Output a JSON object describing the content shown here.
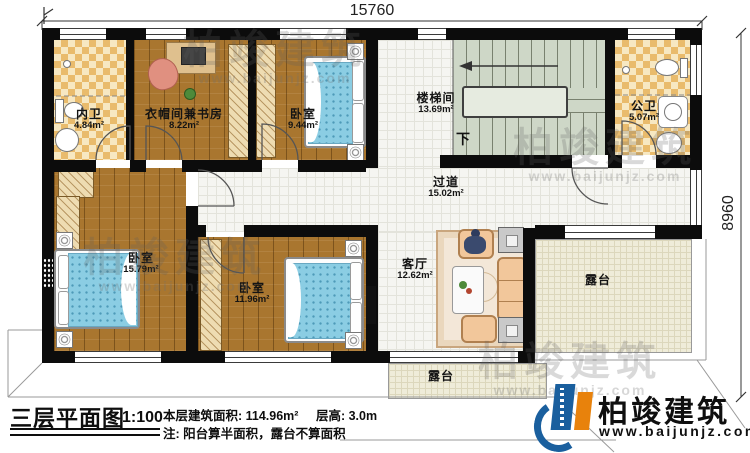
{
  "dimensions": {
    "width_top": "15760",
    "height_right": "8960"
  },
  "rooms": {
    "neiwei": {
      "name": "内卫",
      "area": "4.84m²"
    },
    "cloak_study": {
      "name": "衣帽间兼书房",
      "area": "8.22m²"
    },
    "bedroom_top": {
      "name": "卧室",
      "area": "9.44m²"
    },
    "stairwell": {
      "name": "楼梯间",
      "area": "13.69m²"
    },
    "public_bath": {
      "name": "公卫",
      "area": "5.07m²"
    },
    "corridor": {
      "name": "过道",
      "area": "15.02m²"
    },
    "bedroom_left": {
      "name": "卧室",
      "area": "15.79m²"
    },
    "bedroom_mid": {
      "name": "卧室",
      "area": "11.96m²"
    },
    "living_room": {
      "name": "客厅",
      "area": "12.62m²"
    },
    "terrace_right": {
      "name": "露台"
    },
    "terrace_bottom": {
      "name": "露台"
    }
  },
  "stairs": {
    "down_label": "下"
  },
  "title_block": {
    "title": "三层平面图",
    "scale": "1:100",
    "area_label": "本层建筑面积: 114.96m²",
    "height_label": "层高: 3.0m",
    "note": "注: 阳台算半面积，露台不算面积"
  },
  "brand": {
    "name": "柏竣建筑",
    "website": "www.baijunjz.com"
  },
  "watermark": {
    "name": "柏竣建筑",
    "website": "www.baijunjz.com"
  },
  "colors": {
    "wall": "#0c0c0c",
    "wood_floor": "#a9762f",
    "bath_tile": "#e9bb6c",
    "stair": "#ced7c7",
    "terrace": "#efecd9",
    "bed_blue": "#8bcde3",
    "brand_blue": "#1a5f9e",
    "brand_orange": "#e8820c"
  }
}
